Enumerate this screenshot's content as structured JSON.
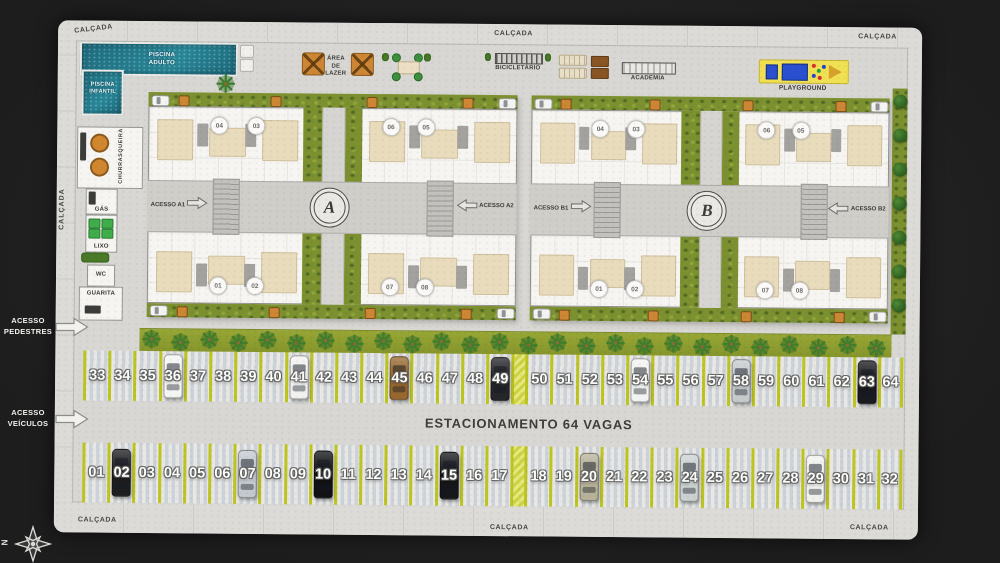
{
  "sidewalk_labels": {
    "top_left": "CALÇADA",
    "top_center": "CALÇADA",
    "top_right": "CALÇADA",
    "left": "CALÇADA",
    "bottom_left": "CALÇADA",
    "bottom_center": "CALÇADA",
    "bottom_right": "CALÇADA"
  },
  "compass": {
    "north": "N"
  },
  "amenities": {
    "piscina_adulto": "PISCINA ADULTO",
    "piscina_infantil": "PISCINA INFANTIL",
    "area_de_lazer": "ÁREA DE LAZER",
    "bicicletario": "BICICLETÁRIO",
    "academia": "ACADEMIA",
    "playground": "PLAYGROUND",
    "churrasqueira": "CHURRASQUEIRA",
    "gas": "GÁS",
    "lixo": "LIXO",
    "wc": "WC",
    "guarita": "GUARITA"
  },
  "site_access": {
    "pedestrians_line1": "ACESSO",
    "pedestrians_line2": "PEDESTRES",
    "vehicles_line1": "ACESSO",
    "vehicles_line2": "VEÍCULOS"
  },
  "buildings": [
    {
      "letter": "A",
      "access_left": "ACESSO A1",
      "access_right": "ACESSO A2",
      "units_top": [
        "04",
        "03",
        "06",
        "05"
      ],
      "units_bottom": [
        "01",
        "02",
        "07",
        "08"
      ]
    },
    {
      "letter": "B",
      "access_left": "ACESSO B1",
      "access_right": "ACESSO B2",
      "units_top": [
        "04",
        "03",
        "06",
        "05"
      ],
      "units_bottom": [
        "01",
        "02",
        "07",
        "08"
      ]
    }
  ],
  "parking": {
    "title": "ESTACIONAMENTO 64 VAGAS",
    "row_top": {
      "gap_after": "49",
      "slots": [
        {
          "n": "33"
        },
        {
          "n": "34"
        },
        {
          "n": "35"
        },
        {
          "n": "36",
          "car": "#f4f4f2"
        },
        {
          "n": "37"
        },
        {
          "n": "38"
        },
        {
          "n": "39"
        },
        {
          "n": "40"
        },
        {
          "n": "41",
          "car": "#f1f2f0"
        },
        {
          "n": "42"
        },
        {
          "n": "43"
        },
        {
          "n": "44"
        },
        {
          "n": "45",
          "car": "#96682f"
        },
        {
          "n": "46"
        },
        {
          "n": "47"
        },
        {
          "n": "48"
        },
        {
          "n": "49",
          "car": "#26262a"
        },
        {
          "n": "50"
        },
        {
          "n": "51"
        },
        {
          "n": "52"
        },
        {
          "n": "53"
        },
        {
          "n": "54",
          "car": "#f3f3f1"
        },
        {
          "n": "55"
        },
        {
          "n": "56"
        },
        {
          "n": "57"
        },
        {
          "n": "58",
          "car": "#c6cacd"
        },
        {
          "n": "59"
        },
        {
          "n": "60"
        },
        {
          "n": "61"
        },
        {
          "n": "62"
        },
        {
          "n": "63",
          "car": "#1b1b1f"
        },
        {
          "n": "64"
        }
      ]
    },
    "row_bottom": {
      "gap_after": "17",
      "slots": [
        {
          "n": "01"
        },
        {
          "n": "02",
          "car": "#1e1e20"
        },
        {
          "n": "03"
        },
        {
          "n": "04"
        },
        {
          "n": "05"
        },
        {
          "n": "06"
        },
        {
          "n": "07",
          "car": "#c4c8cf"
        },
        {
          "n": "08"
        },
        {
          "n": "09"
        },
        {
          "n": "10",
          "car": "#121215"
        },
        {
          "n": "11"
        },
        {
          "n": "12"
        },
        {
          "n": "13"
        },
        {
          "n": "14"
        },
        {
          "n": "15",
          "car": "#17171a"
        },
        {
          "n": "16"
        },
        {
          "n": "17"
        },
        {
          "n": "18"
        },
        {
          "n": "19"
        },
        {
          "n": "20",
          "car": "#b7b29a"
        },
        {
          "n": "21"
        },
        {
          "n": "22"
        },
        {
          "n": "23"
        },
        {
          "n": "24",
          "car": "#cbd1d1"
        },
        {
          "n": "25"
        },
        {
          "n": "26"
        },
        {
          "n": "27"
        },
        {
          "n": "28"
        },
        {
          "n": "29",
          "car": "#f0f0ed"
        },
        {
          "n": "30"
        },
        {
          "n": "31"
        },
        {
          "n": "32"
        }
      ]
    }
  },
  "colors": {
    "background": "#222222",
    "plan_ground": "#d8d7d3",
    "sidewalk": "#dcdbd7",
    "parking_divider": "#bcc41f",
    "grass": "#7c9030",
    "pool_water": "#27808f",
    "playground_yellow": "#f0e053",
    "pergola_orange": "#cd8634"
  }
}
